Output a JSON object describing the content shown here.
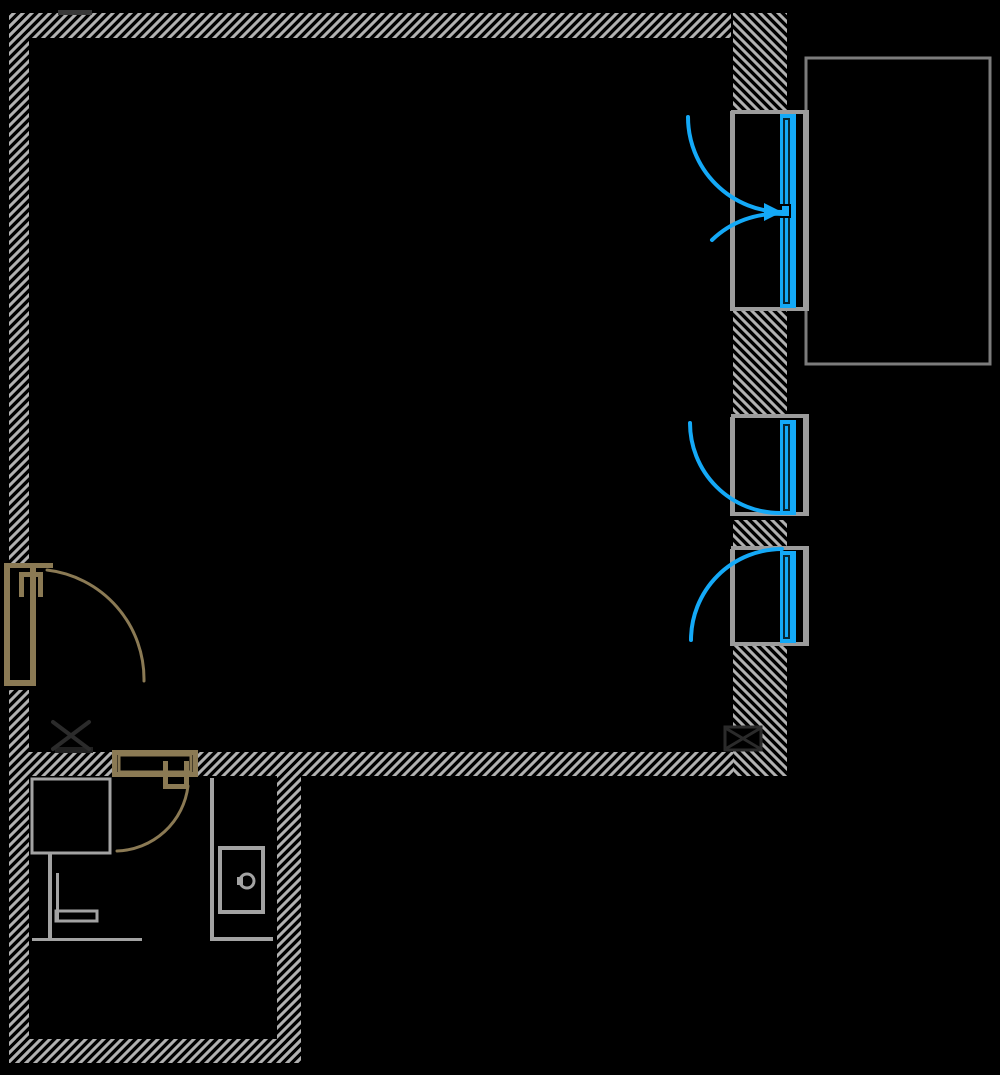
{
  "canvas": {
    "width": 1000,
    "height": 1075,
    "background": "#000000"
  },
  "colors": {
    "wall": "#b1b1b1",
    "frame": "#9c9c9c",
    "glass": "#14a9f7",
    "glass_dark": "#072733",
    "wood": "#8b7a54",
    "fixture": "#a3a3a3",
    "balcony": "#7c7c7c",
    "column": "#2b2b2b",
    "column_fill": "#000000",
    "artifact": "#383838"
  },
  "shapes": [
    {
      "layer": "walls",
      "name": "top-wall",
      "type": "hatch",
      "dir": "f",
      "x": 9,
      "y": 13,
      "w": 722,
      "h": 25,
      "inter": false
    },
    {
      "layer": "walls",
      "name": "left-wall-upper",
      "type": "hatch",
      "dir": "f",
      "x": 9,
      "y": 13,
      "w": 20,
      "h": 550,
      "inter": false
    },
    {
      "layer": "walls",
      "name": "left-wall-lower",
      "type": "hatch",
      "dir": "f",
      "x": 9,
      "y": 690,
      "w": 20,
      "h": 373,
      "inter": false
    },
    {
      "layer": "walls",
      "name": "partition-wall-left",
      "type": "hatch",
      "dir": "f",
      "x": 29,
      "y": 752,
      "w": 83,
      "h": 24,
      "inter": false
    },
    {
      "layer": "walls",
      "name": "partition-wall-right",
      "type": "hatch",
      "dir": "f",
      "x": 198,
      "y": 752,
      "w": 535,
      "h": 24,
      "inter": false
    },
    {
      "layer": "walls",
      "name": "bathroom-south-wall",
      "type": "hatch",
      "dir": "f",
      "x": 9,
      "y": 1039,
      "w": 292,
      "h": 24,
      "inter": false
    },
    {
      "layer": "walls",
      "name": "bathroom-east-wall",
      "type": "hatch",
      "dir": "f",
      "x": 277,
      "y": 752,
      "w": 24,
      "h": 311,
      "inter": false
    },
    {
      "layer": "walls",
      "name": "right-wall-segment-1",
      "type": "hatch",
      "dir": "b",
      "x": 733,
      "y": 13,
      "w": 54,
      "h": 98,
      "inter": false
    },
    {
      "layer": "walls",
      "name": "right-wall-segment-2",
      "type": "hatch",
      "dir": "b",
      "x": 733,
      "y": 311,
      "w": 54,
      "h": 107,
      "inter": false
    },
    {
      "layer": "walls",
      "name": "right-wall-segment-3",
      "type": "hatch",
      "dir": "b",
      "x": 733,
      "y": 520,
      "w": 54,
      "h": 28,
      "inter": false
    },
    {
      "layer": "walls",
      "name": "right-wall-segment-4",
      "type": "hatch",
      "dir": "b",
      "x": 733,
      "y": 646,
      "w": 54,
      "h": 130,
      "inter": false
    },
    {
      "layer": "walls",
      "name": "wall-artifact-mark",
      "type": "rect",
      "x": 58,
      "y": 10,
      "w": 34,
      "h": 5,
      "fill": "artifact",
      "inter": false
    },
    {
      "layer": "balcony",
      "name": "balcony-outline",
      "type": "rect",
      "x": 806,
      "y": 58,
      "w": 184,
      "h": 306,
      "stroke": "balcony",
      "sw": 3,
      "inter": false
    },
    {
      "layer": "windows",
      "name": "balcony-door-jamb-line",
      "type": "rect",
      "x": 730,
      "y": 111,
      "w": 5,
      "h": 200,
      "fill": "frame",
      "inter": true
    },
    {
      "layer": "windows",
      "name": "balcony-door-outer-line",
      "type": "rect",
      "x": 803,
      "y": 111,
      "w": 6,
      "h": 200,
      "fill": "frame",
      "inter": true
    },
    {
      "layer": "windows",
      "name": "balcony-door-head-cap",
      "type": "rect",
      "x": 731,
      "y": 110,
      "w": 78,
      "h": 4,
      "fill": "frame",
      "inter": true
    },
    {
      "layer": "windows",
      "name": "balcony-door-sill-cap",
      "type": "rect",
      "x": 731,
      "y": 307,
      "w": 78,
      "h": 4,
      "fill": "frame",
      "inter": true
    },
    {
      "layer": "windows",
      "name": "balcony-door-panel",
      "type": "rect",
      "x": 780,
      "y": 114,
      "w": 16,
      "h": 194,
      "fill": "glass",
      "inter": true
    },
    {
      "layer": "windows",
      "name": "balcony-door-panel-inline",
      "type": "rect",
      "x": 784,
      "y": 119,
      "w": 5,
      "h": 184,
      "stroke": "glass_dark",
      "sw": 2,
      "inter": true
    },
    {
      "layer": "windows",
      "name": "balcony-door-handle",
      "type": "rect",
      "x": 781,
      "y": 205,
      "w": 9,
      "h": 12,
      "fill": "glass",
      "stroke": "#000000",
      "sw": 2,
      "inter": true
    },
    {
      "layer": "windows",
      "name": "balcony-door-swing-arc",
      "type": "path",
      "d": "M688 117 A95 95 0 0 0 783 212",
      "stroke": "glass",
      "sw": 4,
      "inter": true
    },
    {
      "layer": "windows",
      "name": "balcony-door-tilt-arc",
      "type": "path",
      "d": "M783 214 A94 94 0 0 0 712 240",
      "stroke": "glass",
      "sw": 4,
      "inter": true
    },
    {
      "layer": "windows",
      "name": "balcony-door-arrow",
      "type": "polygon",
      "points": "764,203 764,221 782,212",
      "fill": "glass",
      "inter": true
    },
    {
      "layer": "windows",
      "name": "window-middle-jamb-line",
      "type": "rect",
      "x": 730,
      "y": 417,
      "w": 5,
      "h": 99,
      "fill": "frame",
      "inter": true
    },
    {
      "layer": "windows",
      "name": "window-middle-outer-line",
      "type": "rect",
      "x": 803,
      "y": 417,
      "w": 6,
      "h": 99,
      "fill": "frame",
      "inter": true
    },
    {
      "layer": "windows",
      "name": "window-middle-head-cap",
      "type": "rect",
      "x": 731,
      "y": 414,
      "w": 78,
      "h": 4,
      "fill": "frame",
      "inter": true
    },
    {
      "layer": "windows",
      "name": "window-middle-sill-cap",
      "type": "rect",
      "x": 731,
      "y": 512,
      "w": 78,
      "h": 4,
      "fill": "frame",
      "inter": true
    },
    {
      "layer": "windows",
      "name": "window-middle-panel",
      "type": "rect",
      "x": 780,
      "y": 420,
      "w": 16,
      "h": 95,
      "fill": "glass",
      "inter": true
    },
    {
      "layer": "windows",
      "name": "window-middle-panel-inline",
      "type": "rect",
      "x": 784,
      "y": 425,
      "w": 5,
      "h": 85,
      "stroke": "glass_dark",
      "sw": 2,
      "inter": true
    },
    {
      "layer": "windows",
      "name": "window-middle-swing-arc",
      "type": "path",
      "d": "M690 423 A90 90 0 0 0 780 513",
      "stroke": "glass",
      "sw": 4,
      "inter": true
    },
    {
      "layer": "windows",
      "name": "window-lower-jamb-line",
      "type": "rect",
      "x": 730,
      "y": 549,
      "w": 5,
      "h": 97,
      "fill": "frame",
      "inter": true
    },
    {
      "layer": "windows",
      "name": "window-lower-outer-line",
      "type": "rect",
      "x": 803,
      "y": 549,
      "w": 6,
      "h": 97,
      "fill": "frame",
      "inter": true
    },
    {
      "layer": "windows",
      "name": "window-lower-head-cap",
      "type": "rect",
      "x": 731,
      "y": 546,
      "w": 78,
      "h": 4,
      "fill": "frame",
      "inter": true
    },
    {
      "layer": "windows",
      "name": "window-lower-sill-cap",
      "type": "rect",
      "x": 731,
      "y": 642,
      "w": 78,
      "h": 4,
      "fill": "frame",
      "inter": true
    },
    {
      "layer": "windows",
      "name": "window-lower-panel",
      "type": "rect",
      "x": 780,
      "y": 551,
      "w": 16,
      "h": 92,
      "fill": "glass",
      "inter": true
    },
    {
      "layer": "windows",
      "name": "window-lower-panel-inline",
      "type": "rect",
      "x": 784,
      "y": 556,
      "w": 5,
      "h": 82,
      "stroke": "glass_dark",
      "sw": 2,
      "inter": true
    },
    {
      "layer": "windows",
      "name": "window-lower-swing-arc",
      "type": "path",
      "d": "M691 640 A91 91 0 0 1 782 549",
      "stroke": "glass",
      "sw": 4,
      "inter": true
    },
    {
      "layer": "doors",
      "name": "entry-door-head-bar",
      "type": "rect",
      "x": 4,
      "y": 563,
      "w": 49,
      "h": 5,
      "fill": "wood",
      "inter": true
    },
    {
      "layer": "doors",
      "name": "entry-door-leaf-left-edge",
      "type": "rect",
      "x": 4,
      "y": 563,
      "w": 6,
      "h": 123,
      "fill": "wood",
      "inter": true
    },
    {
      "layer": "doors",
      "name": "entry-door-leaf-right-edge",
      "type": "rect",
      "x": 30,
      "y": 563,
      "w": 6,
      "h": 123,
      "fill": "wood",
      "inter": true
    },
    {
      "layer": "doors",
      "name": "entry-door-bottom-bar",
      "type": "rect",
      "x": 4,
      "y": 680,
      "w": 32,
      "h": 6,
      "fill": "wood",
      "inter": true
    },
    {
      "layer": "doors",
      "name": "entry-door-handle-top",
      "type": "rect",
      "x": 19,
      "y": 572,
      "w": 24,
      "h": 5,
      "fill": "wood",
      "inter": true
    },
    {
      "layer": "doors",
      "name": "entry-door-handle-left-leg",
      "type": "rect",
      "x": 19,
      "y": 572,
      "w": 5,
      "h": 25,
      "fill": "wood",
      "inter": true
    },
    {
      "layer": "doors",
      "name": "entry-door-handle-right-leg",
      "type": "rect",
      "x": 38,
      "y": 572,
      "w": 5,
      "h": 25,
      "fill": "wood",
      "inter": true
    },
    {
      "layer": "doors",
      "name": "entry-door-swing-arc",
      "type": "path",
      "d": "M47 570 A110 110 0 0 1 144 681",
      "stroke": "wood",
      "sw": 3,
      "inter": true
    },
    {
      "layer": "doors",
      "name": "bathroom-door-head-bar",
      "type": "rect",
      "x": 112,
      "y": 750,
      "w": 86,
      "h": 5,
      "fill": "wood",
      "inter": true
    },
    {
      "layer": "doors",
      "name": "bathroom-door-bottom-bar",
      "type": "rect",
      "x": 112,
      "y": 772,
      "w": 86,
      "h": 5,
      "fill": "wood",
      "inter": true
    },
    {
      "layer": "doors",
      "name": "bathroom-door-left-cap",
      "type": "rect",
      "x": 112,
      "y": 750,
      "w": 5,
      "h": 27,
      "fill": "wood",
      "inter": true
    },
    {
      "layer": "doors",
      "name": "bathroom-door-right-cap",
      "type": "rect",
      "x": 193,
      "y": 750,
      "w": 5,
      "h": 27,
      "fill": "wood",
      "inter": true
    },
    {
      "layer": "doors",
      "name": "bathroom-door-leaf",
      "type": "rect",
      "x": 119,
      "y": 755,
      "w": 72,
      "h": 17,
      "stroke": "wood",
      "sw": 3,
      "inter": true
    },
    {
      "layer": "doors",
      "name": "bathroom-door-handle-left-leg",
      "type": "rect",
      "x": 163,
      "y": 761,
      "w": 5,
      "h": 28,
      "fill": "wood",
      "inter": true
    },
    {
      "layer": "doors",
      "name": "bathroom-door-handle-right-leg",
      "type": "rect",
      "x": 184,
      "y": 761,
      "w": 5,
      "h": 28,
      "fill": "wood",
      "inter": true
    },
    {
      "layer": "doors",
      "name": "bathroom-door-handle-bottom",
      "type": "rect",
      "x": 163,
      "y": 784,
      "w": 26,
      "h": 5,
      "fill": "wood",
      "inter": true
    },
    {
      "layer": "doors",
      "name": "bathroom-door-swing-arc",
      "type": "path",
      "d": "M188 786 A74 74 0 0 1 117 851",
      "stroke": "wood",
      "sw": 3,
      "inter": true
    },
    {
      "layer": "columns",
      "name": "left-column-base",
      "type": "rect",
      "x": 55,
      "y": 747,
      "w": 38,
      "h": 6,
      "fill": "#202020",
      "inter": false
    },
    {
      "layer": "columns",
      "name": "left-column-x-marker",
      "type": "path",
      "d": "M53 722 L89 749 M89 722 L53 749",
      "stroke": "column",
      "sw": 4,
      "inter": false
    },
    {
      "layer": "columns",
      "name": "right-column-box",
      "type": "rect",
      "x": 725,
      "y": 727,
      "w": 36,
      "h": 23,
      "fill": "column_fill",
      "stroke": "column",
      "sw": 3,
      "inter": false
    },
    {
      "layer": "columns",
      "name": "right-column-x-marker",
      "type": "path",
      "d": "M727 729 L759 748 M759 729 L727 748",
      "stroke": "column",
      "sw": 3,
      "inter": false
    },
    {
      "layer": "fixtures",
      "name": "shower-tray",
      "type": "rect",
      "x": 32,
      "y": 779,
      "w": 78,
      "h": 74,
      "stroke": "fixture",
      "sw": 3,
      "inter": true
    },
    {
      "layer": "fixtures",
      "name": "grab-bar-vertical",
      "type": "rect",
      "x": 48,
      "y": 853,
      "w": 4,
      "h": 88,
      "fill": "fixture",
      "inter": true
    },
    {
      "layer": "fixtures",
      "name": "grab-bar-vertical-2",
      "type": "rect",
      "x": 56,
      "y": 873,
      "w": 3,
      "h": 48,
      "fill": "fixture",
      "inter": true
    },
    {
      "layer": "fixtures",
      "name": "grab-bar-horizontal",
      "type": "rect",
      "x": 56,
      "y": 911,
      "w": 41,
      "h": 10,
      "stroke": "fixture",
      "sw": 3,
      "inter": true
    },
    {
      "layer": "fixtures",
      "name": "shower-floor-line",
      "type": "rect",
      "x": 32,
      "y": 938,
      "w": 110,
      "h": 3,
      "fill": "fixture",
      "inter": true
    },
    {
      "layer": "fixtures",
      "name": "shower-screen-vertical",
      "type": "rect",
      "x": 210,
      "y": 778,
      "w": 4,
      "h": 163,
      "fill": "fixture",
      "inter": true
    },
    {
      "layer": "fixtures",
      "name": "shower-screen-horizontal",
      "type": "rect",
      "x": 210,
      "y": 937,
      "w": 63,
      "h": 4,
      "fill": "fixture",
      "inter": true
    },
    {
      "layer": "fixtures",
      "name": "toilet-body",
      "type": "rect",
      "x": 220,
      "y": 848,
      "w": 43,
      "h": 64,
      "stroke": "fixture",
      "sw": 4,
      "inter": true
    },
    {
      "layer": "fixtures",
      "name": "toilet-flush-button",
      "type": "circle",
      "cx": 247,
      "cy": 881,
      "r": 7,
      "stroke": "fixture",
      "sw": 3,
      "inter": true
    },
    {
      "layer": "fixtures",
      "name": "toilet-flush-tab",
      "type": "rect",
      "x": 237,
      "y": 877,
      "w": 6,
      "h": 8,
      "fill": "fixture",
      "inter": true
    }
  ]
}
